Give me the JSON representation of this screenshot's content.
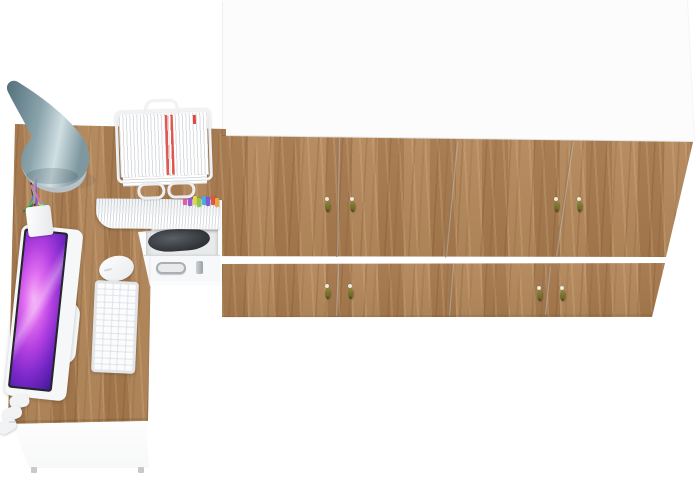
{
  "scene": {
    "label": "Top-down 3D render of a home office furniture set",
    "width": 700,
    "height": 482
  },
  "inventory": [
    "wardrobe-cabinet",
    "l-shaped-desk",
    "desk-lamp",
    "paper-tray",
    "file-shelf",
    "drawer-unit",
    "monitor",
    "keyboard",
    "mouse",
    "pen-cup"
  ],
  "palette": {
    "floor": "#ffffff",
    "wood": "#b2855a",
    "woodShade": "#a67a4e",
    "cabinetTop": "#fcfcfc",
    "seam": "#7d6b56",
    "handleBody": "#6f6b2a",
    "handleCap": "#ecebdc",
    "lampShadeDark": "#53707c",
    "lampShadeMid": "#8ba4ac",
    "lampShadeLight": "#cfdfe2",
    "lampBase": "#b8c2c6",
    "bezel": "#24262c",
    "white": "#f6f7f8",
    "keyGap": "#e3e6e9",
    "paperRed": "#e0453c",
    "metal": "#a9afb3",
    "equipment": "#33373c"
  },
  "wardrobe": {
    "upper_door_count": 4,
    "lower_door_count": 4,
    "handles": [
      {
        "x": 327,
        "y": 197
      },
      {
        "x": 352,
        "y": 197
      },
      {
        "x": 556,
        "y": 197
      },
      {
        "x": 579,
        "y": 197
      },
      {
        "x": 327,
        "y": 284
      },
      {
        "x": 350,
        "y": 284
      },
      {
        "x": 539,
        "y": 286
      },
      {
        "x": 562,
        "y": 286
      }
    ],
    "seams": [
      {
        "x1": 338,
        "y1": 138,
        "x2": 336,
        "y2": 257
      },
      {
        "x1": 456,
        "y1": 142,
        "x2": 445,
        "y2": 257
      },
      {
        "x1": 572,
        "y1": 141,
        "x2": 555,
        "y2": 257
      },
      {
        "x1": 337,
        "y1": 264,
        "x2": 335,
        "y2": 316
      },
      {
        "x1": 452,
        "y1": 264,
        "x2": 448,
        "y2": 316
      },
      {
        "x1": 549,
        "y1": 266,
        "x2": 544,
        "y2": 315
      }
    ]
  },
  "storage_unit": {
    "file_tabs": [
      {
        "x": 183,
        "dy": 0,
        "color": "#e35ba8"
      },
      {
        "x": 188,
        "dy": 1,
        "color": "#9b59d0"
      },
      {
        "x": 193,
        "dy": 0,
        "color": "#e8d44c"
      },
      {
        "x": 197,
        "dy": 2,
        "color": "#85cc4f"
      },
      {
        "x": 202,
        "dy": 0,
        "color": "#4fa8e8"
      },
      {
        "x": 206,
        "dy": 1,
        "color": "#7a5cd6"
      },
      {
        "x": 211,
        "dy": 0,
        "color": "#e05548"
      },
      {
        "x": 215,
        "dy": 2,
        "color": "#eda73c"
      }
    ]
  },
  "desk_items": {
    "pens": [
      {
        "x": 34,
        "y": 206,
        "a": -10,
        "l": 24,
        "c": "#3a3f44"
      },
      {
        "x": 31,
        "y": 207,
        "a": 8,
        "l": 20,
        "c": "#d8434a"
      },
      {
        "x": 38,
        "y": 205,
        "a": -22,
        "l": 20,
        "c": "#e2a23b"
      },
      {
        "x": 42,
        "y": 206,
        "a": -35,
        "l": 17,
        "c": "#e8d24a"
      },
      {
        "x": 28,
        "y": 208,
        "a": 22,
        "l": 18,
        "c": "#4a7de0"
      },
      {
        "x": 25,
        "y": 210,
        "a": 38,
        "l": 15,
        "c": "#58b54e"
      },
      {
        "x": 45,
        "y": 207,
        "a": -48,
        "l": 14,
        "c": "#46c2c9"
      },
      {
        "x": 36,
        "y": 205,
        "a": -4,
        "l": 26,
        "c": "#8a55d0"
      },
      {
        "x": 47,
        "y": 209,
        "a": -60,
        "l": 12,
        "c": "#a8e04e"
      },
      {
        "x": 22,
        "y": 212,
        "a": 55,
        "l": 12,
        "c": "#2f7a3f"
      },
      {
        "x": 40,
        "y": 204,
        "a": -28,
        "l": 22,
        "c": "#e06fb0"
      },
      {
        "x": 33,
        "y": 204,
        "a": 2,
        "l": 28,
        "c": "#9aa0a6"
      }
    ]
  },
  "keyboard": {
    "rows": 14,
    "cols": 5
  },
  "edge_lines": [
    {
      "x1": 222,
      "y1": 2,
      "x2": 222,
      "y2": 136,
      "c": "rgba(0,0,0,0.05)",
      "w": 1
    },
    {
      "x1": 687,
      "y1": 0,
      "x2": 694,
      "y2": 140,
      "c": "rgba(0,0,0,0.045)",
      "w": 1
    },
    {
      "x1": 222,
      "y1": 136,
      "x2": 693,
      "y2": 142,
      "c": "rgba(0,0,0,0.10)",
      "w": 1
    },
    {
      "x1": 222,
      "y1": 257,
      "x2": 666,
      "y2": 257,
      "c": "rgba(0,0,0,0.05)",
      "w": 1
    },
    {
      "x1": 222,
      "y1": 318,
      "x2": 652,
      "y2": 316,
      "c": "rgba(0,0,0,0.06)",
      "w": 2
    },
    {
      "x1": 9,
      "y1": 423,
      "x2": 146,
      "y2": 420,
      "c": "rgba(0,0,0,0.10)",
      "w": 1.5
    },
    {
      "x1": 150,
      "y1": 232,
      "x2": 147,
      "y2": 420,
      "c": "rgba(0,0,0,0.05)",
      "w": 1
    }
  ]
}
